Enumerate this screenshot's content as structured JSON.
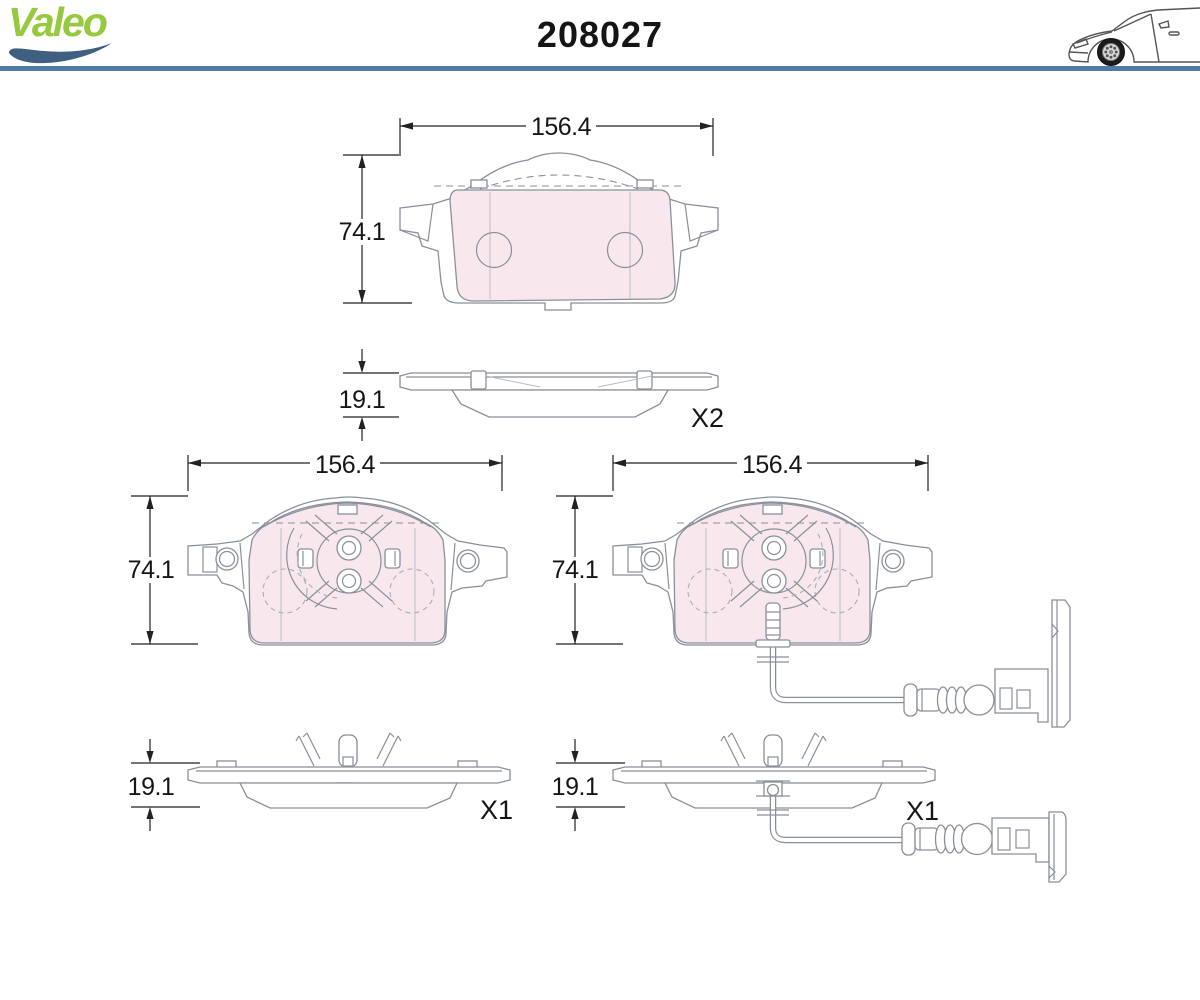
{
  "header": {
    "brand": "Valeo",
    "part_number": "208027"
  },
  "views": {
    "top": {
      "width_mm": "156.4",
      "height_mm": "74.1",
      "thickness_mm": "19.1",
      "quantity": "X2"
    },
    "bottom_left": {
      "width_mm": "156.4",
      "height_mm": "74.1",
      "thickness_mm": "19.1",
      "quantity": "X1"
    },
    "bottom_right": {
      "width_mm": "156.4",
      "height_mm": "74.1",
      "thickness_mm": "19.1",
      "quantity": "X1"
    }
  },
  "icons": {
    "car": "car-icon",
    "swoosh": "valeo-swoosh-icon"
  },
  "colors": {
    "brand_green": "#96c93d",
    "swoosh_blue": "#3e5f80",
    "header_rule_blue": "#4e7ba6",
    "friction_pink": "#f8e8ee",
    "outline_gray": "#8a9099",
    "dimension_black": "#1a1a1a"
  }
}
